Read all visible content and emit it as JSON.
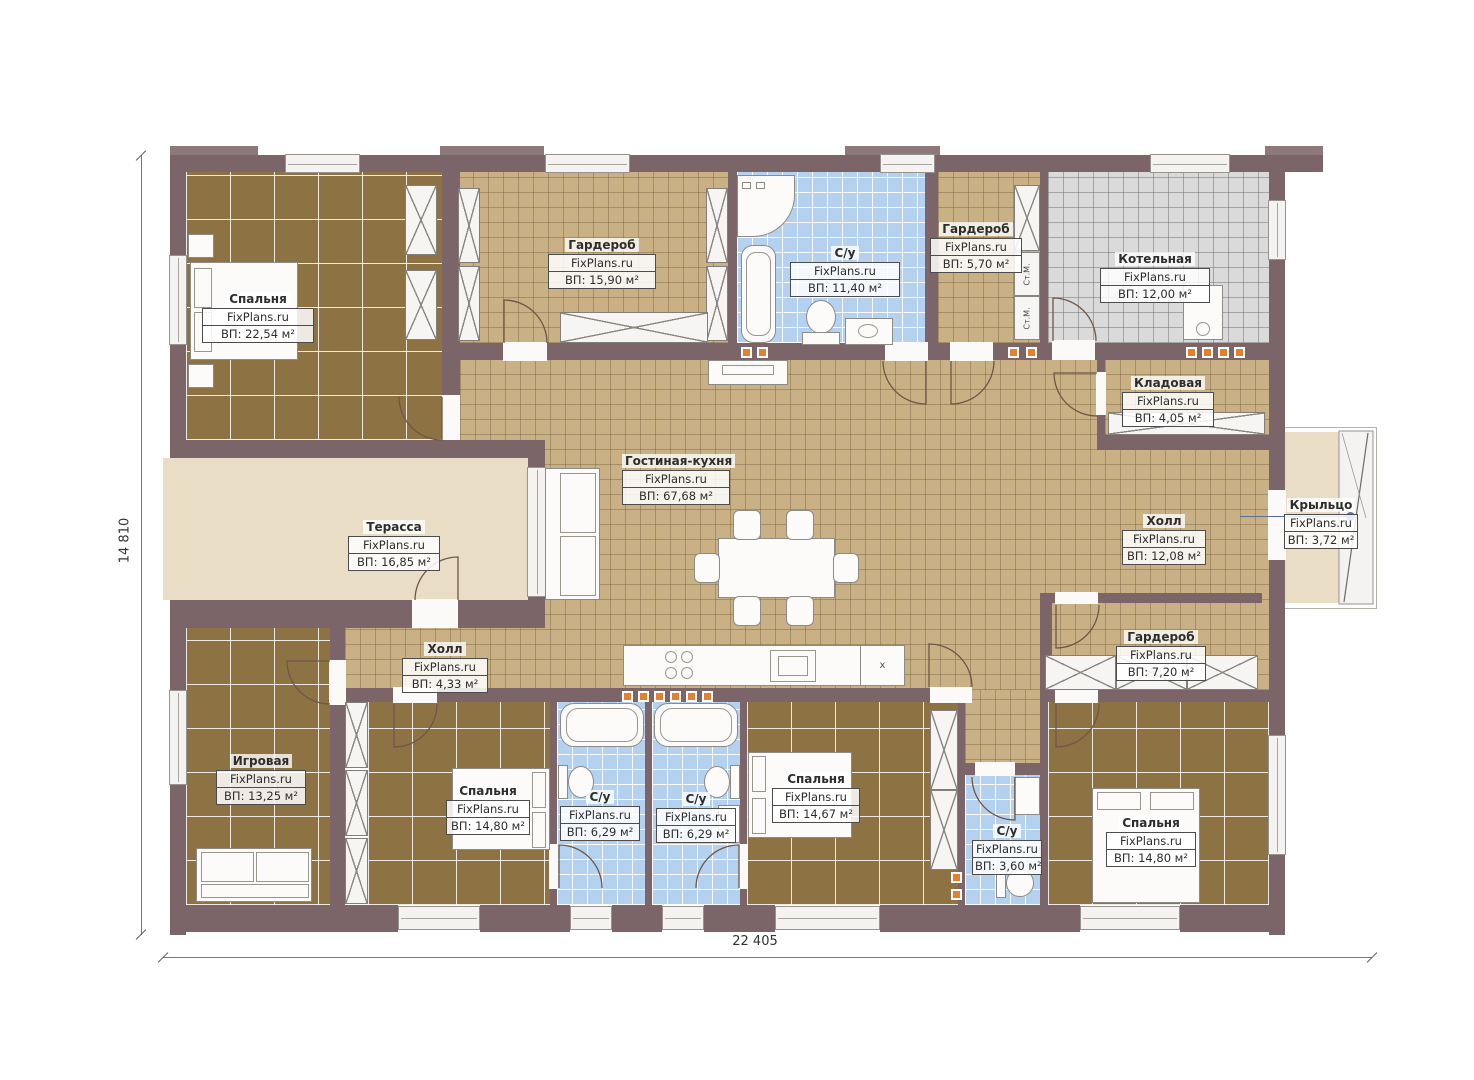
{
  "watermark": "FixPlans.ru",
  "dimensions": {
    "width_total": "22 405",
    "height_total": "14 810"
  },
  "labels": {
    "washing_machine": "Ст.М.",
    "fridge_mark": "x"
  },
  "rooms": [
    {
      "name": "Спальня",
      "area": "ВП: 22,54 м²"
    },
    {
      "name": "Гардероб",
      "area": "ВП: 15,90 м²"
    },
    {
      "name": "С/у",
      "area": "ВП: 11,40 м²"
    },
    {
      "name": "Гардероб",
      "area": "ВП: 5,70 м²"
    },
    {
      "name": "Котельная",
      "area": "ВП: 12,00 м²"
    },
    {
      "name": "Кладовая",
      "area": "ВП: 4,05 м²"
    },
    {
      "name": "Гостиная-кухня",
      "area": "ВП: 67,68 м²"
    },
    {
      "name": "Терасса",
      "area": "ВП: 16,85 м²"
    },
    {
      "name": "Холл",
      "area": "ВП: 12,08 м²"
    },
    {
      "name": "Крыльцо",
      "area": "ВП: 3,72 м²"
    },
    {
      "name": "Гардероб",
      "area": "ВП: 7,20 м²"
    },
    {
      "name": "Холл",
      "area": "ВП: 4,33 м²"
    },
    {
      "name": "Игровая",
      "area": "ВП: 13,25 м²"
    },
    {
      "name": "Спальня",
      "area": "ВП: 14,80 м²"
    },
    {
      "name": "С/у",
      "area": "ВП: 6,29 м²"
    },
    {
      "name": "С/у",
      "area": "ВП: 6,29 м²"
    },
    {
      "name": "Спальня",
      "area": "ВП: 14,67 м²"
    },
    {
      "name": "С/у",
      "area": "ВП: 3,60 м²"
    },
    {
      "name": "Спальня",
      "area": "ВП: 14,80 м²"
    }
  ]
}
